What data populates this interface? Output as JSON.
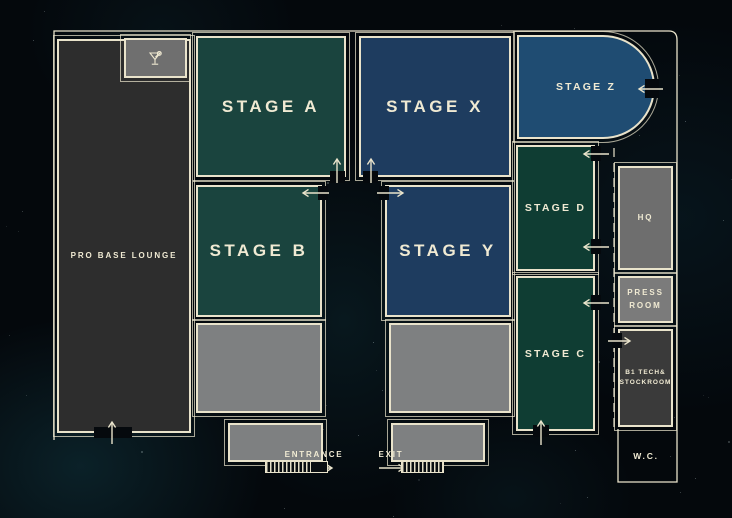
{
  "title": "venue floor plan",
  "palette": {
    "background": "#04080c",
    "wall": "#e9e3cb",
    "text": "#f0ead3",
    "nebula": "#10404d"
  },
  "labels": {
    "entrance": "ENTRANCE",
    "exit": "EXIT",
    "wc": "W.C."
  },
  "rooms": [
    {
      "id": "pro-base-lounge",
      "label": "PRO BASE LOUNGE",
      "color": "#2d2d2d",
      "text_size": "small"
    },
    {
      "id": "lounge-bar",
      "label": "",
      "icon": "cocktail-icon",
      "color": "#6f6f6f",
      "text_size": "small"
    },
    {
      "id": "stage-a",
      "label": "STAGE A",
      "color": "#1a443e",
      "text_size": "large"
    },
    {
      "id": "stage-x",
      "label": "STAGE X",
      "color": "#1e3c5f",
      "text_size": "large"
    },
    {
      "id": "stage-z",
      "label": "STAGE Z",
      "color": "#1f4c72",
      "text_size": "medium"
    },
    {
      "id": "stage-b",
      "label": "STAGE B",
      "color": "#1a443e",
      "text_size": "large"
    },
    {
      "id": "stage-y",
      "label": "STAGE Y",
      "color": "#1e3c5f",
      "text_size": "large"
    },
    {
      "id": "stage-d",
      "label": "STAGE D",
      "color": "#0f3d33",
      "text_size": "medium"
    },
    {
      "id": "stage-c",
      "label": "STAGE C",
      "color": "#0f3d33",
      "text_size": "medium"
    },
    {
      "id": "hq",
      "label": "HQ",
      "color": "#6e6e6e",
      "text_size": "small"
    },
    {
      "id": "press-room",
      "label": "PRESS\nROOM",
      "color": "#7b7b7b",
      "text_size": "small"
    },
    {
      "id": "b1-tech-stockroom",
      "label": "B1 TECH&\nSTOCKROOM",
      "color": "#3a3a3a",
      "text_size": "tiny"
    },
    {
      "id": "area-stage-b-floor",
      "label": "",
      "color": "#7e8081",
      "text_size": "small"
    },
    {
      "id": "area-stage-y-floor",
      "label": "",
      "color": "#7e8081",
      "text_size": "small"
    },
    {
      "id": "entrance-platform",
      "label": "",
      "color": "#7e8081",
      "text_size": "small"
    },
    {
      "id": "exit-platform",
      "label": "",
      "color": "#7e8081",
      "text_size": "small"
    }
  ]
}
